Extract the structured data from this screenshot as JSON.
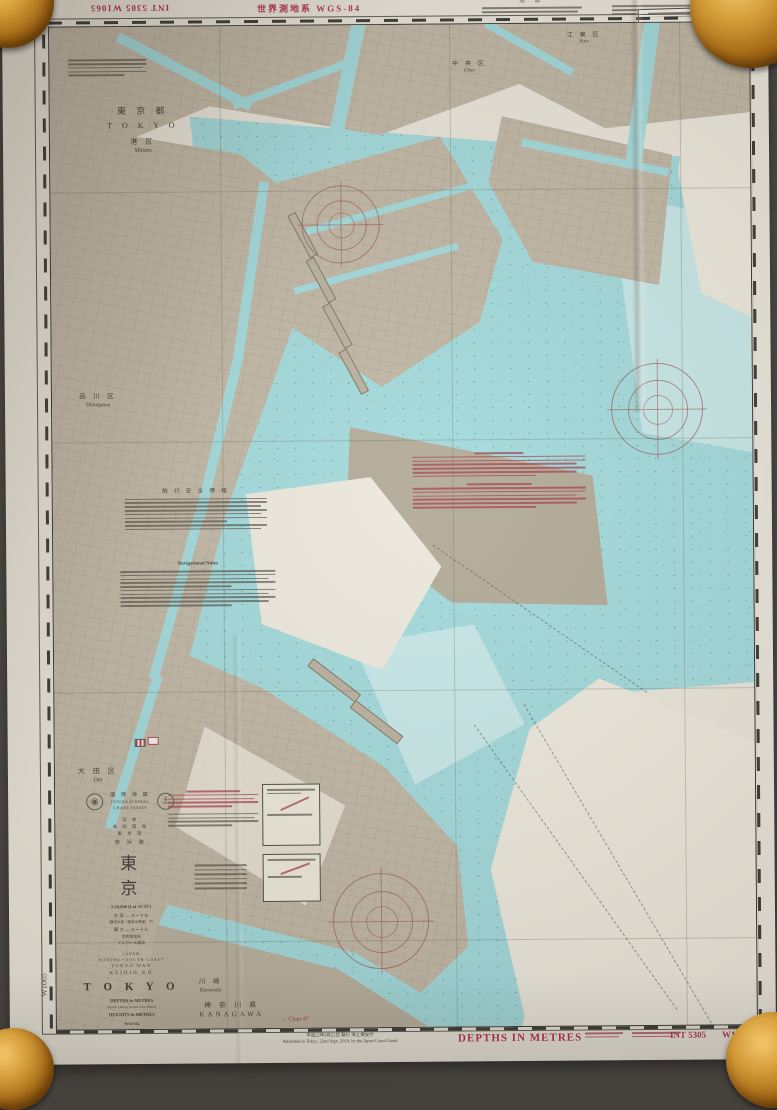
{
  "colors": {
    "paper": "#e9e4d8",
    "land": "#beb4a2",
    "land_dark": "#b0a793",
    "water": "#9fd8da",
    "water_light": "#c5e6e6",
    "accent_magenta": "#b02a50",
    "compass_red": "#96504b",
    "ink": "#2f2d28",
    "floor": "#45423e",
    "knob_amber": "#d29a36"
  },
  "top_margin": {
    "int_flipped": "INT 5305  W1065",
    "datum": "世界測地系  WGS-84",
    "note_jp_title": "注  意",
    "note_en_title": "Note"
  },
  "edges": {
    "right_code": "W1065",
    "left_code": "W1065"
  },
  "regions": {
    "pref": {
      "jp": "東 京 都",
      "en": "T O K Y O"
    },
    "minato": {
      "jp": "港 区",
      "en": "Minato"
    },
    "chuo": {
      "jp": "中 央 区",
      "en": "Chuo"
    },
    "koto": {
      "jp": "江 東 区",
      "en": "Koto"
    },
    "shinagawa": {
      "jp": "品 川 区",
      "en": "Shinagawa"
    },
    "ota": {
      "jp": "大 田 区",
      "en": "Ota"
    },
    "kawasaki": {
      "jp": "川 崎",
      "en": "Kawasaki"
    },
    "kanagawa": {
      "jp": "神 奈 川 県",
      "en": "KANAGAWA"
    }
  },
  "notes": {
    "nav_jp_title": "航 行 安 全 情 報",
    "nav_en_title": "Navigational Notes"
  },
  "title_block": {
    "series_jp": "国 際 海 図",
    "series_en1": "INTERNATIONAL",
    "series_en2": "CHART SERIES",
    "area_jp1": "日 本",
    "area_jp2": "本 州 南 岸",
    "area_jp3": "東 京 湾",
    "port_jp": "京 浜 港",
    "title_jp": "東　　京",
    "scale": "1:10,000 (Lat 35°35′)",
    "depth_jp": "水 深 ― メートル",
    "depth_jp_sub": "（最低水面（基本水準面）下）",
    "height_jp": "高 さ ― メートル",
    "datum_jp": "世界測地系",
    "proj_jp": "メルカトル図法",
    "country_en": "JAPAN",
    "coast_en": "HONSHU－SOUTH COAST",
    "bay_en": "TOKYO WAN",
    "port_en": "KEIHIN KO",
    "title_en": "T O K Y O",
    "depths_en": "DEPTHS in METRES",
    "depths_en_sub": "(below Datum, lowest Low Water)",
    "heights_en": "HEIGHTS in METRES",
    "datum_en": "WGS-84",
    "proj_en": "Mercator Projection",
    "source_en": "Sources of the Hydrographic and Oceanographic Department, J.C.G (H.O.)"
  },
  "bottom_margin": {
    "publish_jp": "平成22年9月22日 発行 海上保安庁",
    "publish_en": "Published in Tokyo, 22nd Sept. 2010, by the Japan Coast Guard",
    "depths": "DEPTHS  IN  METRES",
    "int_no": "INT 5305",
    "chart_no": "W1065",
    "chart_ref": "← Chart 87"
  }
}
